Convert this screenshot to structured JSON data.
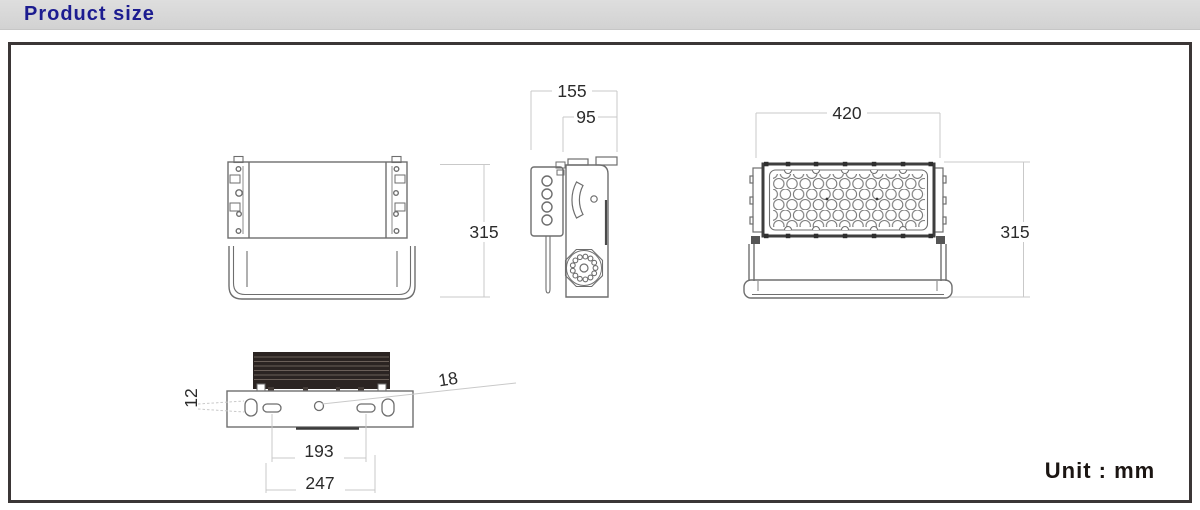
{
  "header": {
    "title": "Product size"
  },
  "footer": {
    "unit_label": "Unit : mm"
  },
  "dimensions": {
    "back_height": "315",
    "side_overall_depth": "155",
    "side_body_depth": "95",
    "front_width": "420",
    "front_height": "315",
    "bottom_oval_width": "12",
    "bottom_center_hole": "18",
    "bottom_slot_spacing": "193",
    "bottom_outer_spacing": "247"
  },
  "colors": {
    "title_text": "#1c1c90",
    "title_bar_bg": "#d8d8d8",
    "box_border": "#3b3636",
    "outline": "#6e6e6e",
    "dimension_line": "#c9c9c9",
    "dimension_text": "#2b2b2b",
    "heatsink": "#2b2422",
    "panel_border": "#3e3e3e"
  }
}
